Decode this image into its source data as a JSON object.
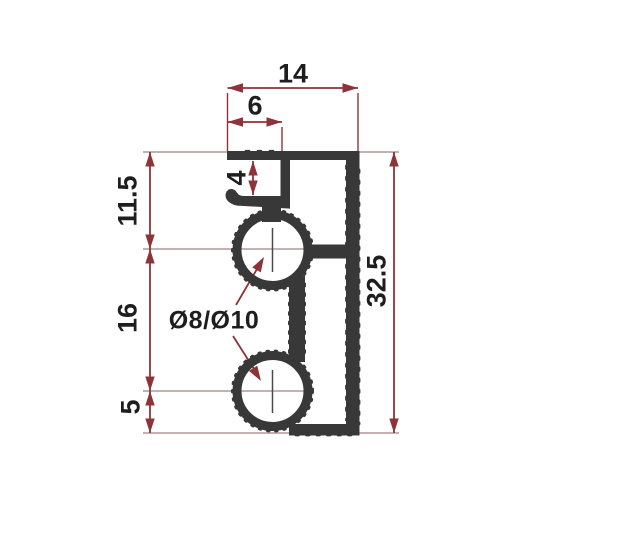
{
  "drawing": {
    "type": "profile-cross-section-dimension-drawing",
    "labels": {
      "d14": "14",
      "d6": "6",
      "d4": "4",
      "d11_5": "11.5",
      "d16": "16",
      "d5": "5",
      "d32_5": "32.5",
      "bore": "Ø8/Ø10"
    },
    "dimensions_mm": {
      "top_width": 14,
      "flange_offset": 6,
      "slot_opening": 4,
      "top_to_upper_channel_center": 11.5,
      "channel_center_spacing": 16,
      "lower_channel_center_to_bottom": 5,
      "overall_height": 32.5,
      "channel_bore_label": "Ø8/Ø10"
    },
    "colors": {
      "profile": "#383838",
      "dimension_line": "#8e3338",
      "extension_line": "#a08484",
      "label_text": "#1e1e1e",
      "background": "#ffffff"
    }
  }
}
